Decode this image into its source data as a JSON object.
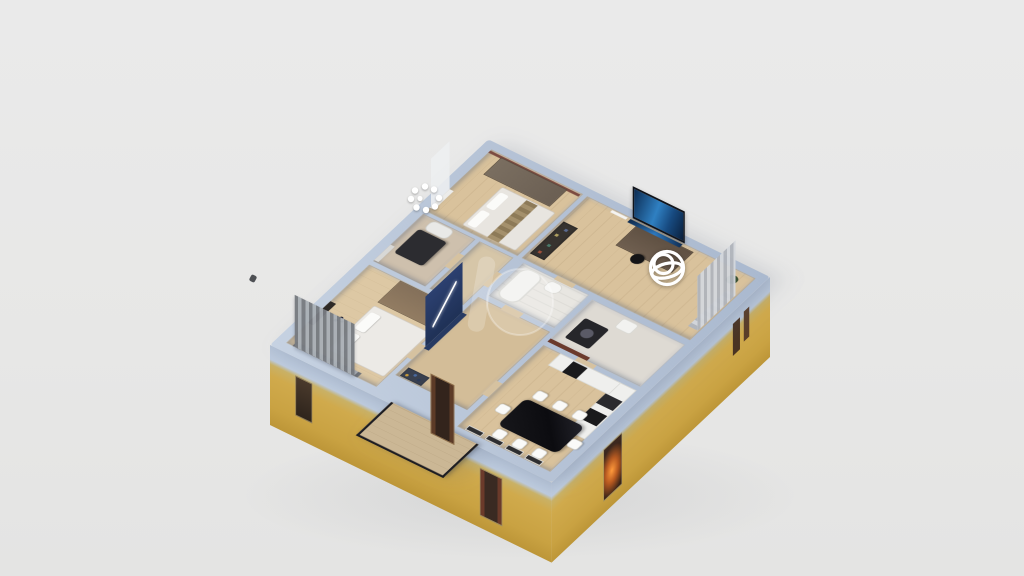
{
  "app": {
    "name": "3D Floor Plan Viewer",
    "view": "dollhouse-3d"
  },
  "scene": {
    "background_color": "#e8e8e7",
    "wall_cap_color": "#b7c4d7",
    "exterior_wall_color": "#cfa94b",
    "slab_band_color": "#b2c0d4",
    "floor_wood_color": "#d9c29c",
    "accent_navy_color": "#24365e",
    "tv_screen_color": "#2f7cc4",
    "rooms": [
      {
        "id": "bedroom-left",
        "label": "Bedroom with bed, wardrobe, striped curtains, photo wall"
      },
      {
        "id": "den",
        "label": "Den with dark table and ceiling light"
      },
      {
        "id": "corridor",
        "label": "Corridor"
      },
      {
        "id": "bedroom-top",
        "label": "Bedroom with wardrobe, accent wall and bed"
      },
      {
        "id": "hallway",
        "label": "Hallway with navy accent wall and shelf"
      },
      {
        "id": "bathroom-center",
        "label": "Bathroom with tub and toilet"
      },
      {
        "id": "bathroom",
        "label": "Bathroom with washing machine and sink"
      },
      {
        "id": "kitchen-dining",
        "label": "Kitchen and dining room with black table, white chairs, cabinets, oven"
      },
      {
        "id": "office-tv",
        "label": "Office TV room with wall TV, desk, chair, bookshelf, curtains, plant"
      },
      {
        "id": "balcony",
        "label": "Balcony with dark railing"
      }
    ],
    "markers": [
      {
        "id": "pano-marker",
        "type": "360-panorama-hotspot",
        "shape": "white wireframe sphere",
        "color": "#ffffff",
        "room": "office-tv"
      },
      {
        "id": "ceiling-light",
        "type": "light-fixture",
        "shape": "ring of 9 white bulbs",
        "color": "#ffffff",
        "room": "den"
      }
    ],
    "watermark": {
      "id": "render-watermark",
      "shape": "translucent bar and circle",
      "color": "#ffffff",
      "opacity": 0.2
    },
    "exterior": {
      "windows": [
        "small window SW",
        "balcony door SW",
        "window SW",
        "lit window SE",
        "window sliver SE 1",
        "window sliver SE 2"
      ],
      "balcony_railing_color": "#1d1d22",
      "lit_window_glow_color": "#ff9a3c"
    }
  }
}
